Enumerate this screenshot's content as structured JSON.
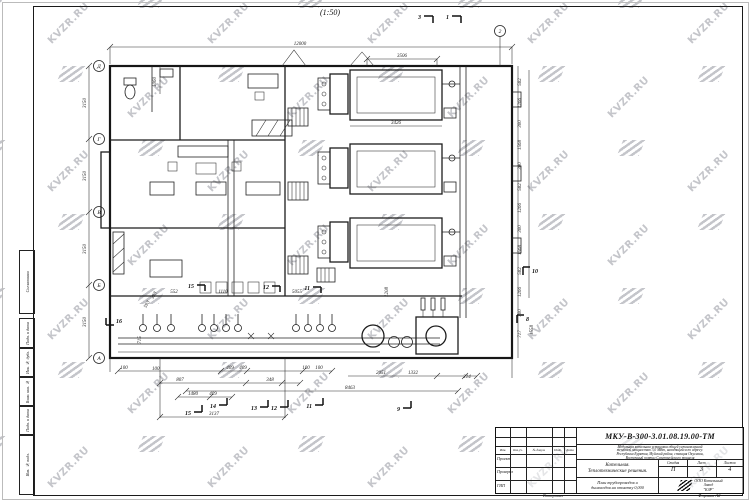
{
  "watermark": {
    "text": "KVZR.RU"
  },
  "sheet": {
    "scale_label": "(1:50)",
    "copied_label": "Копировал",
    "format_label": "Формат А2"
  },
  "side_stamp": {
    "labels": [
      "Согласовано",
      "Подп. и дата",
      "Инв. № дубл.",
      "Взам. инв. №",
      "Подп. и дата",
      "Инв. № подл."
    ]
  },
  "title_block": {
    "doc_number": "МКУ-В-300-3.01.08.19.00-ТМ",
    "description_lines": [
      "Модульная котельная установка общей установленной",
      "тепловой мощностью 3,0 МВт, находящейся по адресу:",
      "Республика Бурятия, Муйский район, станция Окусикан,",
      "Восточный портал Северомуйского тоннеля"
    ],
    "object_name_line1": "Котельная.",
    "object_name_line2": "Теплотехнические решения.",
    "stage_label": "Стадия",
    "sheet_label": "Лист",
    "sheets_label": "Листов",
    "stage": "П",
    "sheet": "3",
    "sheets": "4",
    "drawing_title_line1": "План трубопроводов и",
    "drawing_title_line2": "дымоходов на отметку 0,000",
    "company_line1": "ООО Котельный",
    "company_line2": "Завод",
    "company_line3": "\"КЗР\"",
    "header_cols": [
      "Изм.",
      "Кол.уч.",
      "№ докум.",
      "Подп.",
      "Дата"
    ],
    "rows": [
      "Проект.",
      "Проверил",
      "ГИП"
    ]
  },
  "axes": {
    "left": [
      "Д",
      "Г",
      "В",
      "Б",
      "А"
    ],
    "top": [
      "2"
    ]
  },
  "dims": {
    "top": [
      "12000",
      "3506"
    ],
    "inner": [
      "3426",
      "552",
      "1110",
      "5055",
      "1208"
    ],
    "left": [
      "1060",
      "3150",
      "3150",
      "3150",
      "3150",
      "593",
      "393",
      "715",
      "100"
    ],
    "right": [
      "582",
      "1266",
      "300",
      "1568",
      "300",
      "582",
      "1266",
      "300",
      "1568",
      "582",
      "1266",
      "300",
      "717",
      "1558"
    ],
    "bottom": [
      "100",
      "807",
      "409",
      "409",
      "348",
      "100",
      "100",
      "2051",
      "1332",
      "214",
      "1480",
      "409",
      "8463",
      "3137"
    ]
  },
  "markers": {
    "m1": "1",
    "m3": "3",
    "m8": "8",
    "m9": "9",
    "m10": "10",
    "m11": "11",
    "m12": "12",
    "m13": "13",
    "m14": "14",
    "m15": "15",
    "m16": "16"
  }
}
